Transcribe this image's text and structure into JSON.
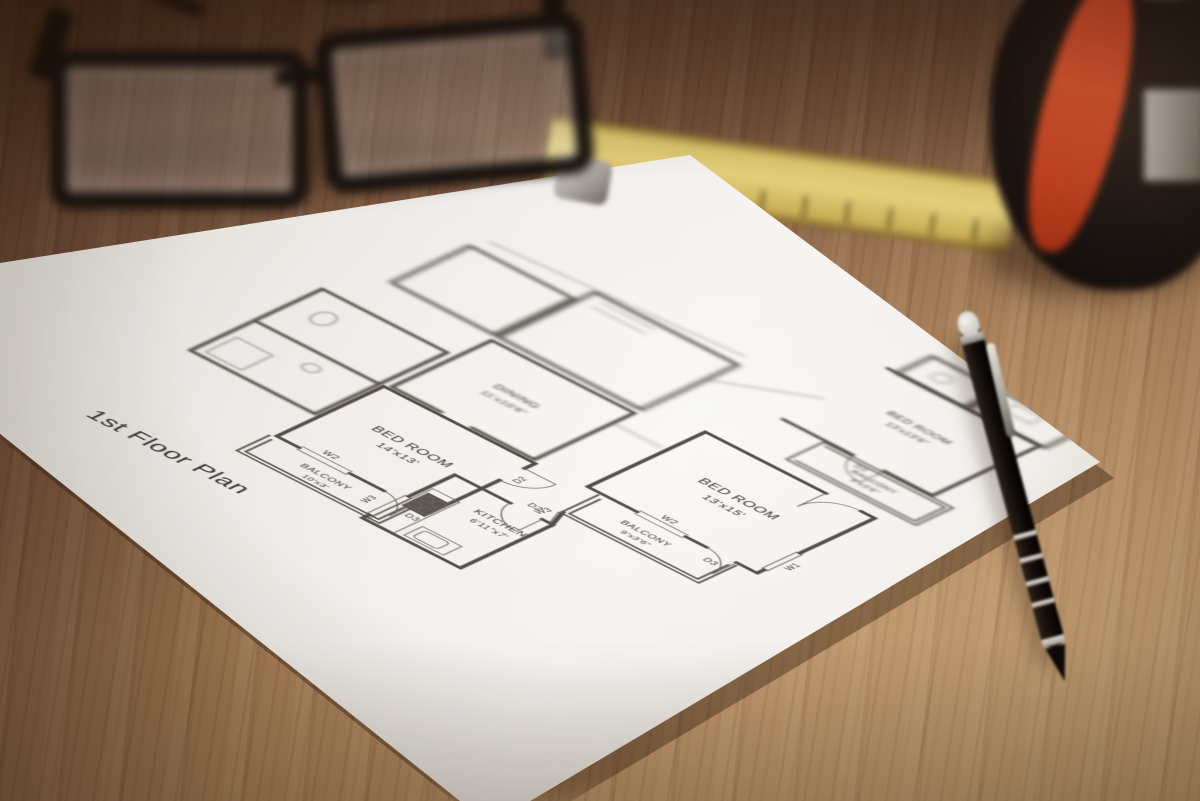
{
  "scene": {
    "setting": "Architectural blueprint photographed on a wooden desk",
    "objects": {
      "glasses": "black rectangular eyeglasses",
      "ruler": "yellow wooden ruler",
      "pencil": "black mechanical pencil with silver rings",
      "tape_measure": "black and orange tape measure",
      "paper": "white floor plan sheet"
    },
    "colors": {
      "wood_light": "#c49c6e",
      "wood_dark": "#6b4a33",
      "paper": "#f0ede9",
      "ink": "#3b3530",
      "ruler_yellow": "#d9c36c",
      "tape_orange": "#e35a33",
      "pencil_black": "#17110c"
    }
  },
  "floor_plan": {
    "title": "1st Floor Plan",
    "rooms": [
      {
        "name": "BED ROOM",
        "dims": "14'x13'"
      },
      {
        "name": "BALCONY",
        "dims": "10'x3'"
      },
      {
        "name": "KITCHEN",
        "dims": "6'11\"x7'"
      },
      {
        "name": "DINING",
        "dims": "11'x10'6\""
      },
      {
        "name": "BED ROOM",
        "dims": "13'x15'"
      },
      {
        "name": "BALCONY",
        "dims": "9'x3'6\""
      },
      {
        "name": "BED ROOM",
        "dims": "13'x13'6\""
      },
      {
        "name": "BALCONY",
        "dims": "9'x3'6\""
      }
    ],
    "markers": {
      "w1": "W1",
      "w2": "W2",
      "w3": "W3",
      "d2": "D2",
      "d3": "D3"
    }
  }
}
